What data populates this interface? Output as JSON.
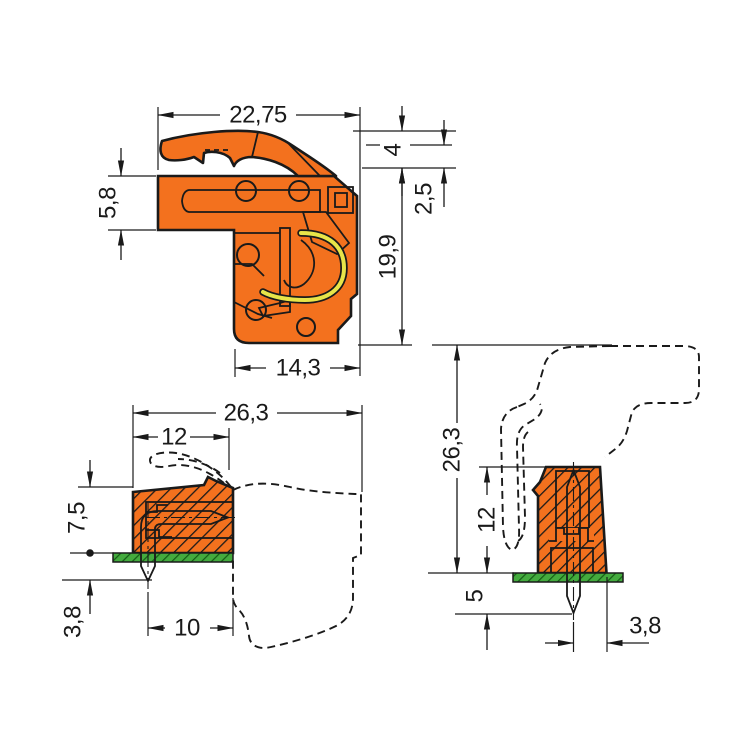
{
  "drawing": {
    "type": "technical-dimension-drawing",
    "background": "#ffffff",
    "colors": {
      "housing_orange": "#F3711E",
      "contact_copper": "#F5BD92",
      "clamp_spring_yellow": "#E8E549",
      "pcb_green": "#44AB3E",
      "pcb_hatch_green": "#145C14",
      "outline_black": "#1a1a1a"
    },
    "view_side_section": {
      "title": "female-plug-side-cross-section",
      "dims": {
        "overall_width": "22,75",
        "latch_height": "4",
        "strain_relief_offset": "2,5",
        "body_height": "19,9",
        "upper_section_height": "5,8",
        "lower_width": "14,3"
      }
    },
    "view_angled_header": {
      "title": "angled-header-on-pcb-side-view",
      "dims": {
        "overall_length": "26,3",
        "header_length": "12",
        "height_above_pcb": "7,5",
        "pin_length_below_pcb": "3,8",
        "pin_setback": "10"
      }
    },
    "view_vertical_header": {
      "title": "vertical-header-on-pcb-front-view",
      "dims": {
        "overall_height": "26,3",
        "header_height": "12",
        "pin_length_below_pcb": "5",
        "pin_center_to_edge": "3,8"
      }
    }
  }
}
